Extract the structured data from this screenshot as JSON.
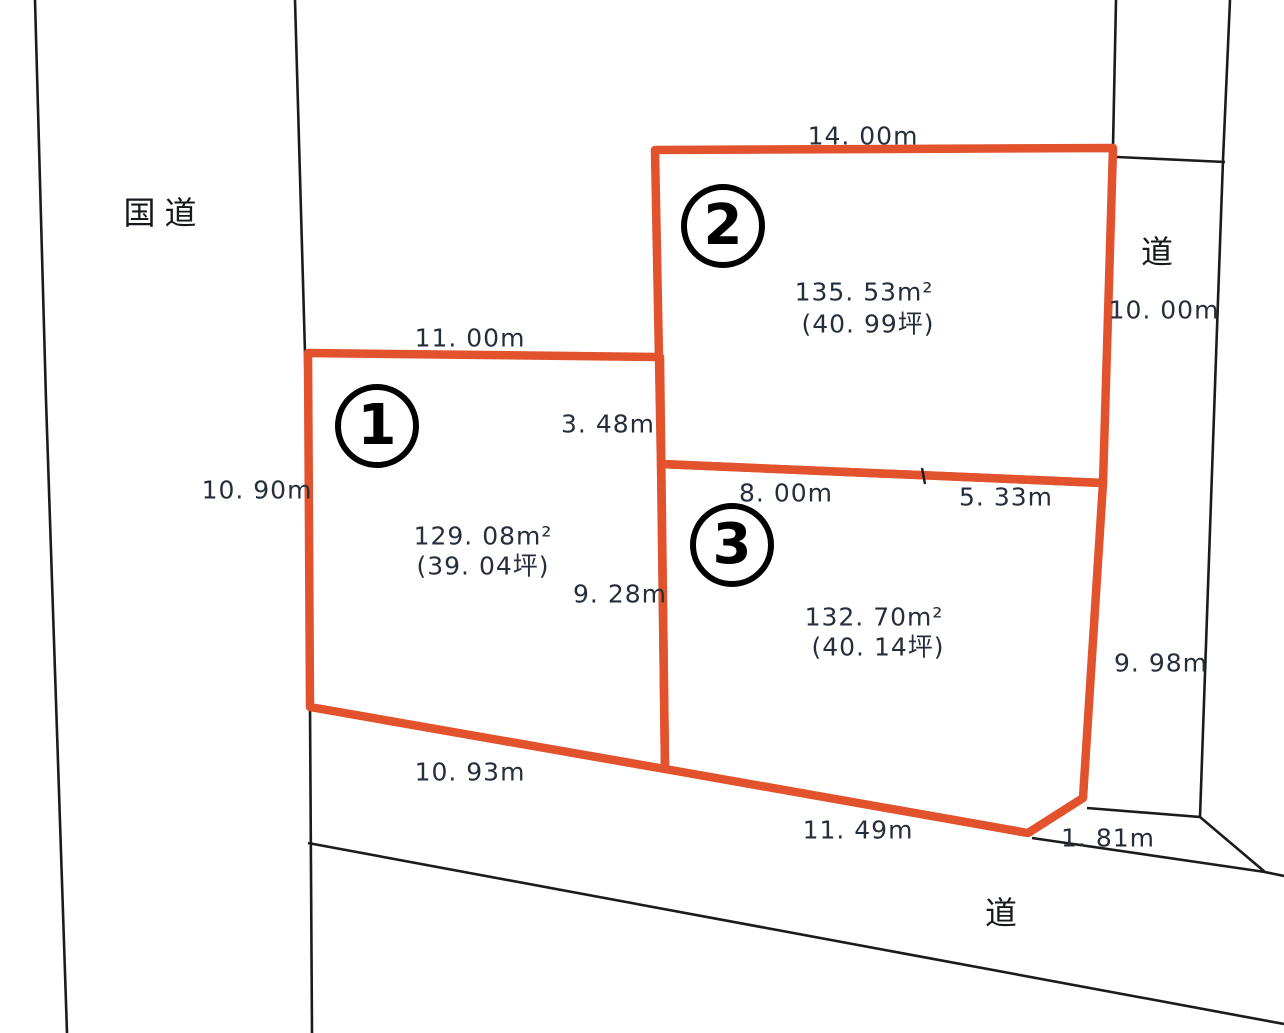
{
  "colors": {
    "lot_outline": "#e2522d",
    "boundary_line": "#1b1b1b",
    "dim_text": "#262e3c",
    "badge_line": "#000000",
    "page_bg": "#ffffff"
  },
  "roads": {
    "national_road_label": "国道",
    "east_road": {
      "label": "道"
    },
    "south_road": {
      "label": "道"
    }
  },
  "lots": [
    {
      "number": "1",
      "area_m2": "129. 08m²",
      "area_tsubo": "(39. 04坪)",
      "dims": {
        "north": "11. 00m",
        "west": "10. 90m",
        "east_upper": "3. 48m",
        "east_lower": "9. 28m",
        "south": "10. 93m"
      }
    },
    {
      "number": "2",
      "area_m2": "135. 53m²",
      "area_tsubo": "(40. 99坪)",
      "dims": {
        "north": "14. 00m",
        "east": "10. 00m"
      }
    },
    {
      "number": "3",
      "area_m2": "132. 70m²",
      "area_tsubo": "(40. 14坪)",
      "dims": {
        "north_west": "8. 00m",
        "north_east": "5. 33m",
        "east": "9. 98m",
        "south": "11. 49m",
        "southeast_cut": "1. 81m"
      }
    }
  ]
}
